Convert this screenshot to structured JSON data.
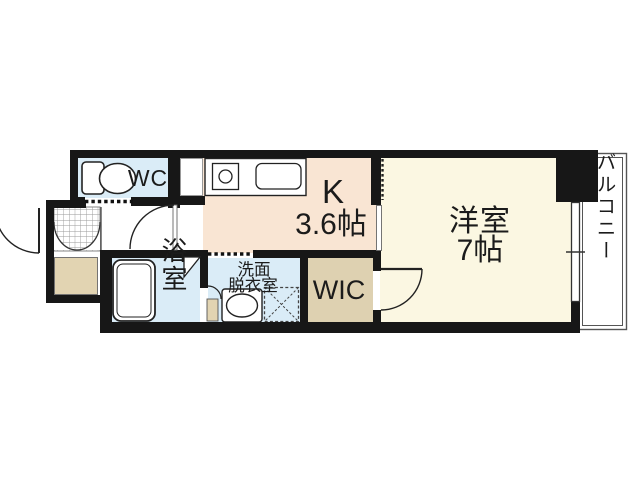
{
  "palette": {
    "wall": "#171717",
    "kitchen_floor": "#f9e5d3",
    "room_floor": "#fbf7e2",
    "wet_area_floor": "#daecf7",
    "closet_floor": "#ded1b1",
    "genkan_floor": "#e2d4b2",
    "fixture_line": "#222222",
    "balcony_line": "#555555"
  },
  "rooms": {
    "wc": {
      "label": "WC"
    },
    "kitchen": {
      "label": "K",
      "size": "3.6帖"
    },
    "western_room": {
      "label": "洋室",
      "size": "7帖"
    },
    "bathroom": {
      "label": "浴室"
    },
    "washroom": {
      "label_line1": "洗面",
      "label_line2": "脱衣室"
    },
    "wic": {
      "label": "WIC"
    },
    "balcony": {
      "label": "バルコニー"
    }
  },
  "fixtures": [
    "toilet-icon",
    "stove-icon",
    "kitchen-sink-icon",
    "bathtub-icon",
    "washbasin-icon",
    "washing-machine-pan-icon",
    "entry-door-swing-icon",
    "hall-door-swing-icon",
    "room-door-swing-icon",
    "folding-door-icon",
    "shoe-cabinet-doors-icon",
    "accordion-curtain-icon",
    "sliding-door-icon",
    "window-icon"
  ]
}
